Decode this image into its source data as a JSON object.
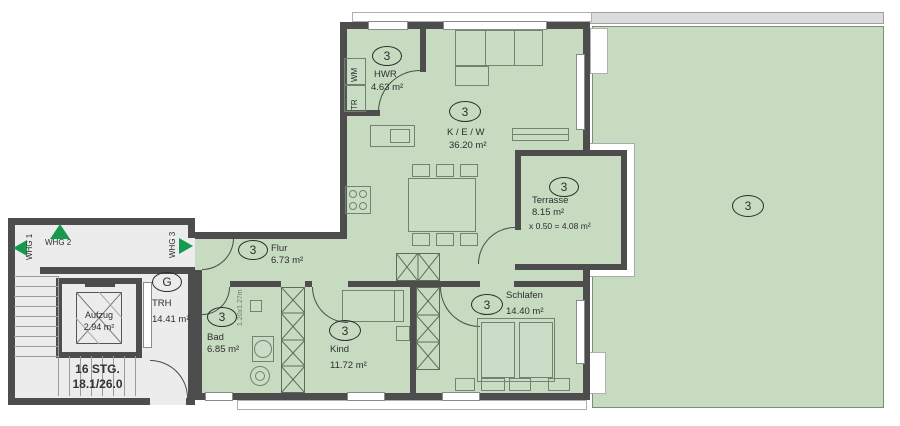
{
  "corridor": {
    "whg1": "WHG 1",
    "whg2": "WHG 2",
    "whg3": "WHG 3"
  },
  "stairwell": {
    "badge": "G",
    "trh": "TRH",
    "trh_area": "14.41 m²",
    "aufzug": "Aufzug",
    "aufzug_area": "2.94 m²",
    "stairs_count": "16 STG.",
    "stairs_dim": "18.1/26.0"
  },
  "rooms": {
    "hwr": {
      "badge": "3",
      "name": "HWR",
      "area": "4.63 m²"
    },
    "kew": {
      "badge": "3",
      "name": "K / E / W",
      "area": "36.20 m²"
    },
    "flur": {
      "badge": "3",
      "name": "Flur",
      "area": "6.73 m²"
    },
    "bad": {
      "badge": "3",
      "name": "Bad",
      "area": "6.85 m²"
    },
    "kind": {
      "badge": "3",
      "name": "Kind",
      "area": "11.72 m²"
    },
    "schlafen": {
      "badge": "3",
      "name": "Schlafen",
      "area": "14.40 m²"
    },
    "terrasse": {
      "badge": "3",
      "name": "Terrasse",
      "area": "8.15 m²",
      "calc": "x 0.50 = 4.08 m²"
    },
    "garten": {
      "badge": "3"
    }
  },
  "appliances": {
    "tr": "TR",
    "wm": "WM"
  },
  "annotations": {
    "shaft_dim": "1.20x1.27m"
  },
  "colors": {
    "room": "#c7dbc1",
    "wall": "#4d4d4d",
    "stair": "#ececec",
    "arrow": "#169a50",
    "roof": "#dcdcdc"
  }
}
